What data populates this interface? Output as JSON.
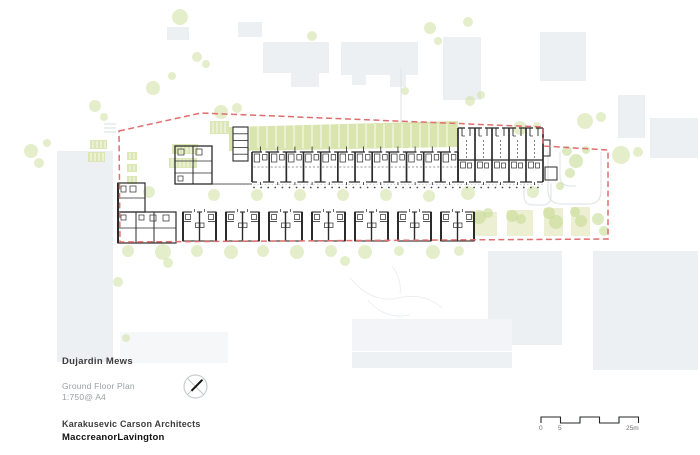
{
  "title_block": {
    "project": "Dujardin Mews",
    "drawing": "Ground Floor Plan",
    "scale": "1:750@ A4",
    "architect_primary": "Karakusevic Carson Architects",
    "architect_secondary": "MaccreanorLavington"
  },
  "scale_bar": {
    "labels": [
      "0",
      "5",
      "25m"
    ],
    "length_label": "25m"
  },
  "plan": {
    "colors": {
      "context": "#edf0f3",
      "band": "#d9e4ae",
      "tree": "#cfe0a0",
      "bush": "#c6db92",
      "garden": "#edefd2",
      "red": "#de6f6e",
      "ink": "#2b2b2b",
      "path": "#e2e6e9",
      "faint": "#eceff1"
    },
    "boundary": "119,131 201,113 543,127 543,146 608,150 608,239 120,242",
    "band": {
      "points": "229,127 458,121 458,147 229,151",
      "sep_x0": 240,
      "sep_step": 9,
      "sep_n": 24,
      "sep_y0": 124,
      "sep_y1": 148
    },
    "context": [
      [
        57,
        151,
        56,
        211
      ],
      [
        167,
        27,
        22,
        13
      ],
      [
        238,
        22,
        24,
        15
      ],
      [
        263,
        42,
        66,
        31
      ],
      [
        291,
        73,
        28,
        14
      ],
      [
        341,
        42,
        77,
        33
      ],
      [
        352,
        75,
        14,
        10
      ],
      [
        390,
        75,
        16,
        12
      ],
      [
        443,
        37,
        38,
        63
      ],
      [
        540,
        32,
        46,
        49
      ],
      [
        618,
        95,
        27,
        43
      ],
      [
        650,
        118,
        48,
        40
      ],
      [
        488,
        251,
        74,
        94
      ],
      [
        593,
        251,
        105,
        119
      ],
      [
        352,
        319,
        160,
        32,
        "#f2f4f7"
      ],
      [
        352,
        352,
        160,
        16,
        "#eef1f4"
      ],
      [
        120,
        332,
        108,
        31,
        "#f5f7f9"
      ]
    ],
    "paths": [
      "M548,152 v38 q0,14 14,14 h26 q13,0 13,-13 v-39",
      "M560,152 v24 q0,10 10,10 h6",
      "M524,183 v13 q0,9 9,9 h9 q9,0 9,-9 v-13",
      "M401,68 V124"
    ],
    "faint_paths": [
      "M350,278 q22,26 48,20 t44,10",
      "M368,300 q16,20 42,15",
      "M392,266 q10,14 8,28"
    ],
    "hatch": [
      [
        104,
        124,
        116,
        124
      ],
      [
        104,
        128,
        116,
        128
      ],
      [
        104,
        132,
        116,
        132
      ]
    ],
    "planters": [
      [
        210,
        121,
        19,
        13
      ],
      [
        172,
        144,
        26,
        10
      ],
      [
        169,
        158,
        28,
        10
      ],
      [
        127,
        152,
        10,
        8
      ],
      [
        127,
        164,
        10,
        8
      ],
      [
        127,
        176,
        10,
        8
      ],
      [
        90,
        140,
        17,
        9
      ],
      [
        88,
        152,
        17,
        10
      ]
    ],
    "gardens": [
      [
        473,
        212,
        24,
        24
      ],
      [
        507,
        210,
        26,
        26
      ],
      [
        544,
        208,
        19,
        28
      ],
      [
        571,
        207,
        19,
        29
      ]
    ],
    "trees": [
      [
        31,
        151,
        7
      ],
      [
        39,
        163,
        5
      ],
      [
        47,
        143,
        4
      ],
      [
        95,
        106,
        6
      ],
      [
        104,
        117,
        4
      ],
      [
        153,
        88,
        7
      ],
      [
        180,
        17,
        8
      ],
      [
        197,
        57,
        5
      ],
      [
        206,
        64,
        4
      ],
      [
        172,
        76,
        4
      ],
      [
        221,
        112,
        7
      ],
      [
        237,
        108,
        5
      ],
      [
        312,
        36,
        5
      ],
      [
        430,
        28,
        6
      ],
      [
        438,
        41,
        4
      ],
      [
        405,
        91,
        4
      ],
      [
        470,
        101,
        5
      ],
      [
        481,
        95,
        4
      ],
      [
        468,
        22,
        5
      ],
      [
        520,
        128,
        7
      ],
      [
        537,
        126,
        4
      ],
      [
        585,
        121,
        8
      ],
      [
        601,
        117,
        5
      ],
      [
        621,
        155,
        9
      ],
      [
        638,
        152,
        5
      ],
      [
        149,
        192,
        6
      ],
      [
        214,
        195,
        6
      ],
      [
        257,
        195,
        6
      ],
      [
        300,
        195,
        6
      ],
      [
        343,
        195,
        6
      ],
      [
        386,
        195,
        6
      ],
      [
        429,
        196,
        6
      ],
      [
        468,
        193,
        7
      ],
      [
        533,
        192,
        6
      ],
      [
        128,
        251,
        6
      ],
      [
        163,
        252,
        8
      ],
      [
        197,
        251,
        6
      ],
      [
        231,
        252,
        7
      ],
      [
        263,
        251,
        6
      ],
      [
        297,
        252,
        7
      ],
      [
        331,
        251,
        6
      ],
      [
        365,
        252,
        7
      ],
      [
        399,
        251,
        5
      ],
      [
        433,
        252,
        7
      ],
      [
        459,
        251,
        5
      ],
      [
        168,
        263,
        5
      ],
      [
        345,
        261,
        5
      ],
      [
        118,
        282,
        5
      ],
      [
        126,
        338,
        4
      ]
    ],
    "bushes": [
      [
        567,
        151,
        5
      ],
      [
        576,
        161,
        7
      ],
      [
        570,
        173,
        5
      ],
      [
        586,
        150,
        4
      ],
      [
        560,
        186,
        4
      ],
      [
        598,
        219,
        6
      ],
      [
        604,
        231,
        5
      ],
      [
        479,
        217,
        7
      ],
      [
        488,
        213,
        5
      ],
      [
        512,
        216,
        6
      ],
      [
        521,
        219,
        5
      ],
      [
        549,
        213,
        6
      ],
      [
        556,
        222,
        7
      ],
      [
        575,
        212,
        5
      ],
      [
        581,
        221,
        6
      ]
    ],
    "dots": {
      "y": 187.5,
      "x0": 254,
      "step": 7.1,
      "n": 41
    },
    "front_line": [
      212,
      184.2,
      543,
      184.2
    ],
    "terrace": {
      "x0": 252,
      "pitch": 17.17,
      "n": 12,
      "y": 152,
      "h": 30
    },
    "deep": {
      "x0": 458,
      "pitch": 17,
      "n": 5,
      "y": 128,
      "h": 54
    },
    "pairs": {
      "xs": [
        183,
        226,
        269,
        312,
        355,
        398,
        441
      ],
      "w": 33,
      "y": 212,
      "h": 29
    },
    "extra_rects": [
      [
        118,
        183,
        27,
        29,
        1.2
      ],
      [
        118,
        212,
        58,
        31,
        1.2
      ],
      [
        175,
        146,
        37,
        38,
        1.3
      ],
      [
        543,
        140,
        7,
        16,
        1
      ],
      [
        545,
        167,
        12,
        13,
        1
      ]
    ],
    "bin": {
      "x": 233,
      "y": 127,
      "w": 15,
      "h": 34,
      "cells": 5
    },
    "rooms": [
      [
        121,
        186,
        5,
        6
      ],
      [
        130,
        186,
        6,
        6
      ],
      [
        121,
        215,
        5,
        5
      ],
      [
        139,
        215,
        5,
        5
      ],
      [
        150,
        215,
        6,
        6
      ],
      [
        163,
        215,
        6,
        6
      ],
      [
        178,
        149,
        6,
        6
      ],
      [
        196,
        149,
        6,
        6
      ],
      [
        178,
        176,
        5,
        5
      ]
    ],
    "extra_lines": [
      [
        118,
        198,
        145,
        198,
        0.8
      ],
      [
        136,
        212,
        136,
        243,
        1
      ],
      [
        154,
        212,
        154,
        243,
        1
      ],
      [
        118,
        228,
        176,
        228,
        0.7
      ],
      [
        193,
        146,
        193,
        184,
        1
      ],
      [
        175,
        161,
        212,
        161,
        0.7
      ],
      [
        175,
        173,
        212,
        173,
        0.7
      ],
      [
        212,
        184,
        252,
        184,
        0.7
      ],
      [
        118,
        183,
        118,
        243,
        2
      ]
    ],
    "scale_bar_path": "M541,423 v-6 h19.5 v6 h19.5 v-6 h19.5 v6 h19.5 v-6 h19.5 v6"
  }
}
